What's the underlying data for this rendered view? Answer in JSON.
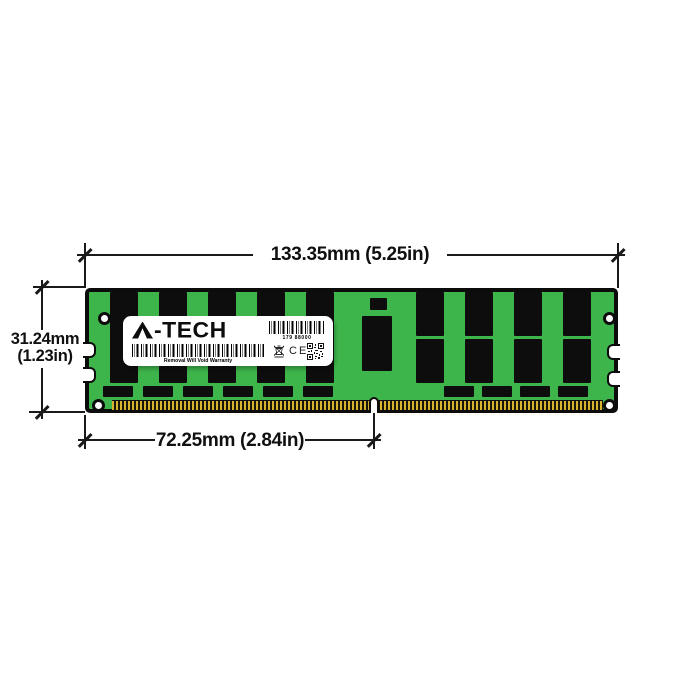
{
  "diagram_title": "Memory module dimension diagram",
  "dimensions": {
    "width_label": "133.35mm (5.25in)",
    "height_label_line1": "31.24mm",
    "height_label_line2": "(1.23in)",
    "pin_span_label": "72.25mm (2.84in)"
  },
  "module": {
    "label": {
      "brand": "A-TECH",
      "logo_suffix": "-TECH",
      "serial_number": "179 88000",
      "warranty_text": "Removal Will Void Warranty",
      "ce_mark": "CE"
    }
  },
  "colors": {
    "pcb_green": "#3eb54b",
    "chip_black": "#0d0d0d",
    "pin_gold": "#d6b42e",
    "outline_black": "#0c0c0c",
    "label_white": "#ffffff"
  },
  "icons": {
    "barcode-icon": "vertical stripe barcode",
    "qr-code-icon": "small QR code",
    "weee-bin-icon": "crossed-out wheeled bin",
    "mounting-hole": "white circular hole",
    "key-notch": "gold-pin key notch",
    "edge-notch": "side edge notch"
  }
}
